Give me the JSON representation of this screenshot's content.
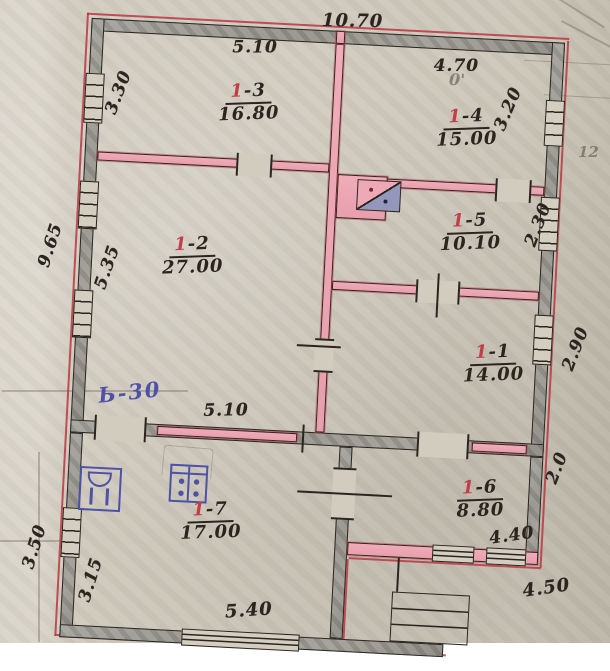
{
  "document_type": "floor-plan",
  "colors": {
    "paper": "#cdc7ba",
    "wall_grey": "#a09e97",
    "wall_pink": "#eda7b3",
    "ink_black": "#2b2520",
    "ink_red": "#bb3642",
    "ink_blue": "#4d52a8",
    "stove_fill": "#9297bb"
  },
  "rooms": [
    {
      "num_red": "1",
      "num_black": "-3",
      "area": "16.80"
    },
    {
      "num_red": "1",
      "num_black": "-4",
      "area": "15.00"
    },
    {
      "num_red": "1",
      "num_black": "-2",
      "area": "27.00"
    },
    {
      "num_red": "1",
      "num_black": "-5",
      "area": "10.10"
    },
    {
      "num_red": "1",
      "num_black": "-1",
      "area": "14.00"
    },
    {
      "num_red": "1",
      "num_black": "-7",
      "area": "17.00"
    },
    {
      "num_red": "1",
      "num_black": "-6",
      "area": "8.80"
    }
  ],
  "dimensions": {
    "overall_top": "10.70",
    "room13_width": "5.10",
    "room14_width": "4.70",
    "left_upper": "3.30",
    "left_overall": "9.65",
    "left_mid": "5.35",
    "right_upper": "3.20",
    "right_mid": "2.30",
    "right_lower": "2.90",
    "inner_bottom": "5.10",
    "veranda_left_outer": "3.50",
    "veranda_left_inner": "3.15",
    "veranda_bottom": "5.40",
    "room16_width": "4.40",
    "porch_width": "4.50",
    "veranda_right": "2.0"
  },
  "annotations": {
    "blue_note": "Ь-30",
    "pencil_mark": "0'",
    "pencil_number": "12"
  }
}
